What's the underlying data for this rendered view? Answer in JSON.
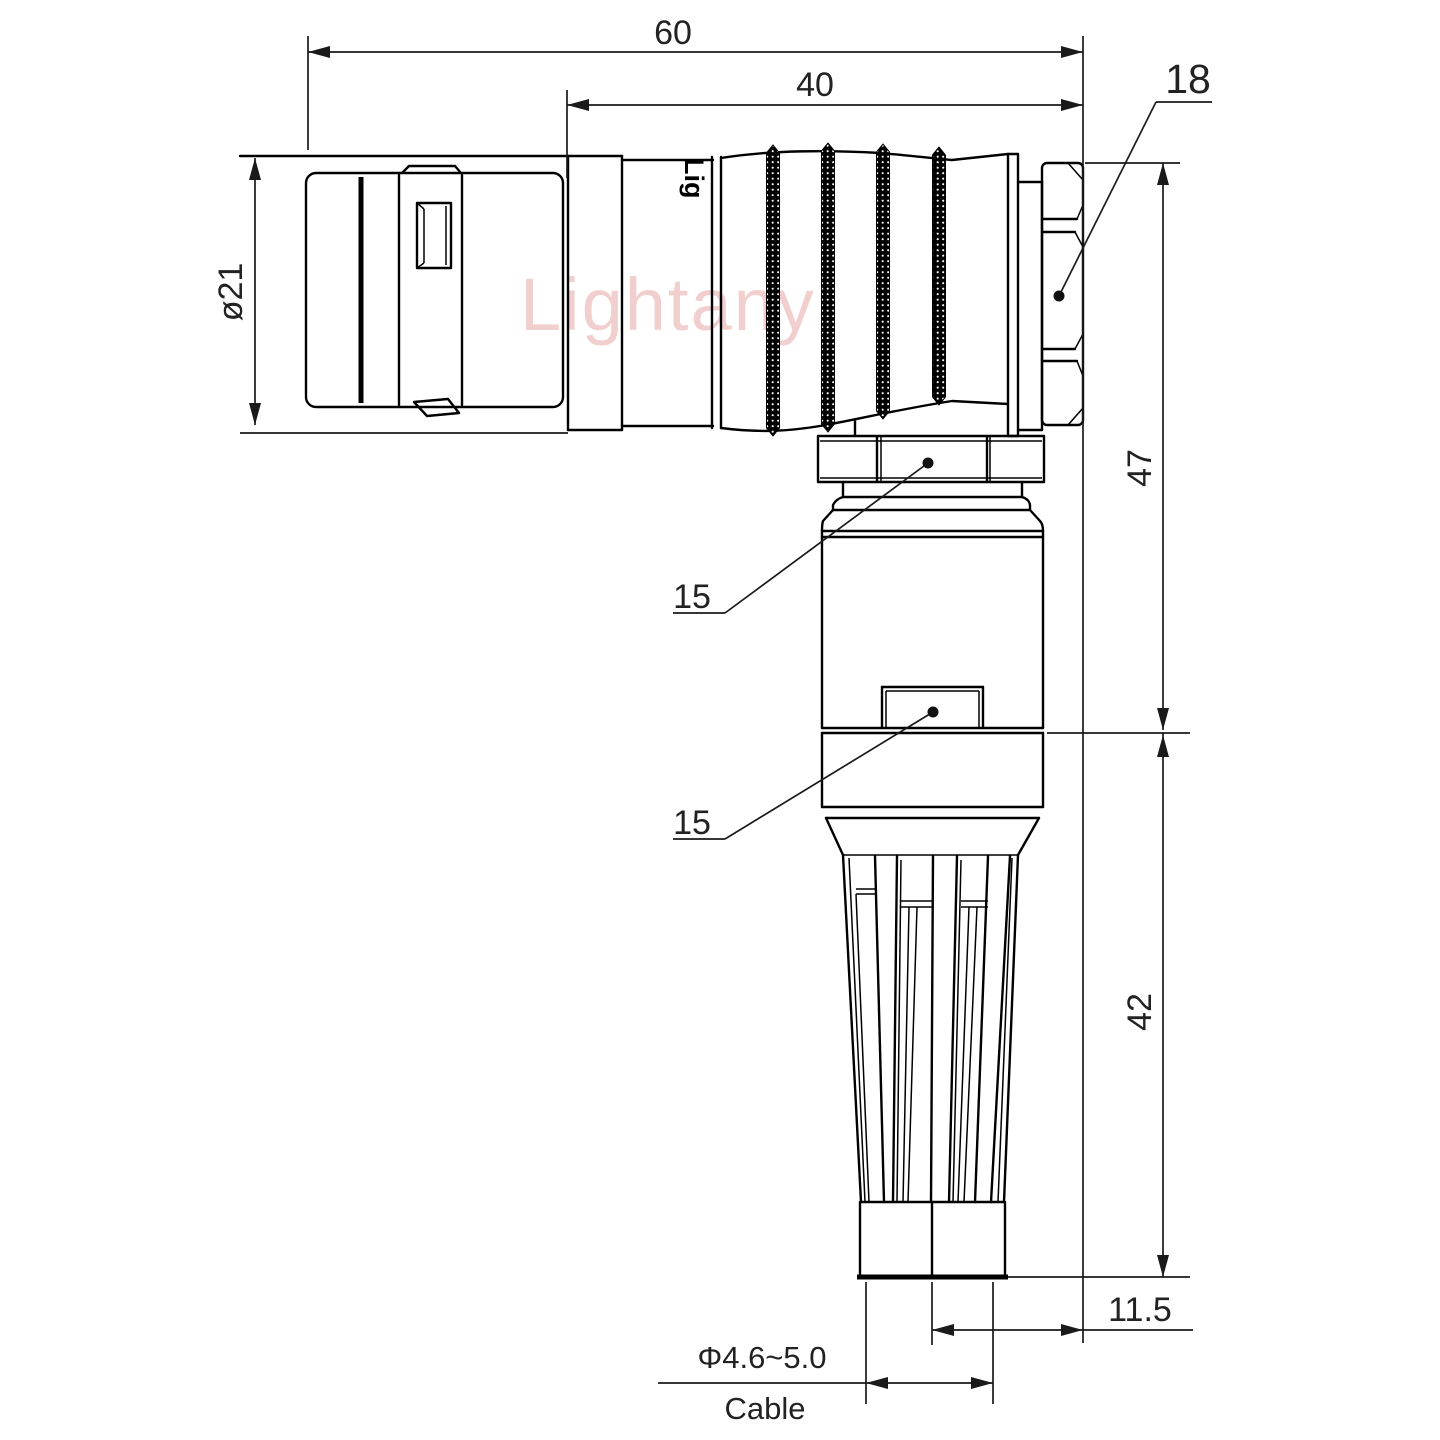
{
  "watermark_text": "Lightany",
  "body_logo_text": "Lig",
  "dimensions": {
    "overall_length": "60",
    "rear_section_length": "40",
    "rear_nut_size": "18",
    "front_diameter": "ø21",
    "coupling_nut_callout": "15",
    "body_callout": "15",
    "elbow_height_upper": "47",
    "strain_relief_height": "42",
    "cable_axis_offset": "11.5",
    "cable_diameter_range": "Φ4.6~5.0",
    "cable_label": "Cable"
  }
}
